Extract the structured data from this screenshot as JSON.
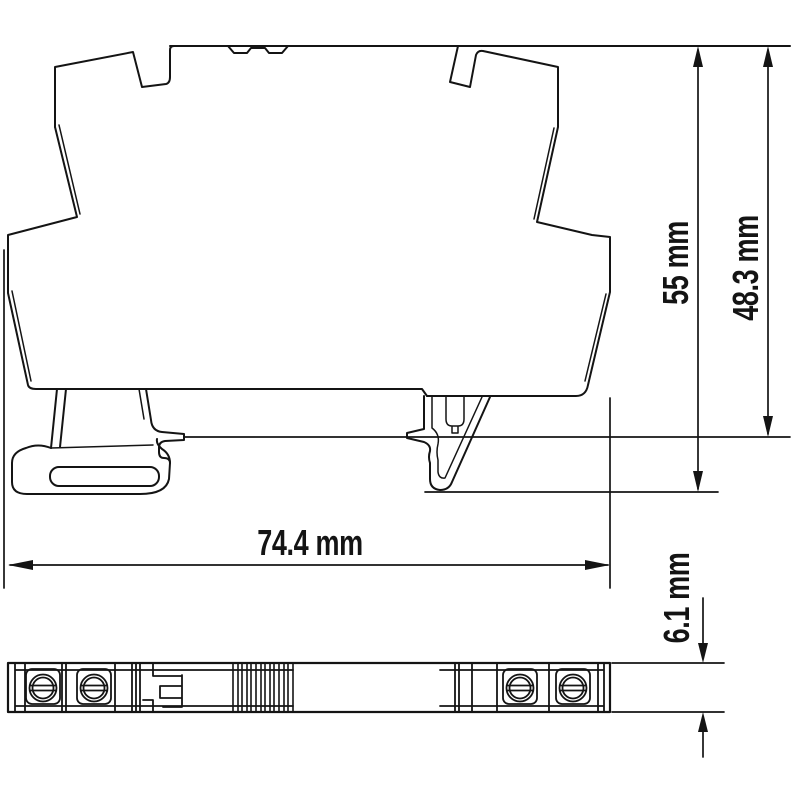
{
  "drawing": {
    "title": "din-rail-module-dimension-drawing",
    "background_color": "#ffffff",
    "line_color": "#141414",
    "views": {
      "side_view": {
        "name": "side-profile-with-din-rail-foot"
      },
      "bottom_view": {
        "name": "bottom-profile-with-screw-terminals",
        "terminal_count": 4
      }
    },
    "dimensions": {
      "height_total": {
        "label": "55 mm",
        "value": 55,
        "unit": "mm",
        "orientation": "vertical"
      },
      "height_rail": {
        "label": "48.3 mm",
        "value": 48.3,
        "unit": "mm",
        "orientation": "vertical"
      },
      "width_total": {
        "label": "74.4 mm",
        "value": 74.4,
        "unit": "mm",
        "orientation": "horizontal"
      },
      "depth": {
        "label": "6.1 mm",
        "value": 6.1,
        "unit": "mm",
        "orientation": "vertical"
      }
    }
  }
}
